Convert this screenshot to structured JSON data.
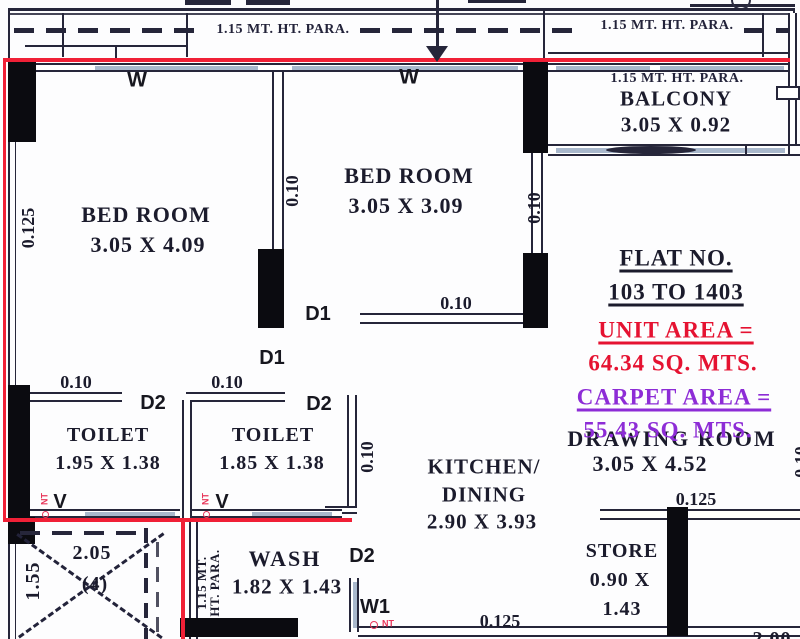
{
  "colors": {
    "ink": "#26263a",
    "wall_black": "#0b0b10",
    "window_blue": "#a9b8cc",
    "red_highlight_line": "#f02036",
    "flat_no_text": "#15151f",
    "unit_area_text": "#e51231",
    "carpet_area_text": "#8d2cd6",
    "vent_red_text": "#e8365a"
  },
  "top_band": {
    "parapet_left": "1.15 MT. HT. PARA.",
    "parapet_right": "1.15 MT. HT. PARA."
  },
  "balcony": {
    "parapet": "1.15 MT. HT. PARA.",
    "name": "BALCONY",
    "dims": "3.05 X 0.92"
  },
  "rooms": {
    "bedroom_left": {
      "name": "BED ROOM",
      "dims": "3.05 X 4.09"
    },
    "bedroom_mid": {
      "name": "BED ROOM",
      "dims": "3.05 X 3.09"
    },
    "toilet_left": {
      "name": "TOILET",
      "dims": "1.95 X 1.38"
    },
    "toilet_mid": {
      "name": "TOILET",
      "dims": "1.85 X 1.38"
    },
    "kitchen": {
      "name_line1": "KITCHEN/",
      "name_line2": "DINING",
      "dims": "2.90 X 3.93"
    },
    "drawing_room": {
      "name": "DRAWING ROOM",
      "dims": "3.05 X 4.52"
    },
    "wash": {
      "name": "WASH",
      "dims": "1.82 X 1.43"
    },
    "store": {
      "name": "STORE",
      "dims_line1": "0.90 X",
      "dims_line2": "1.43"
    }
  },
  "title_block": {
    "flat_no_label": "FLAT NO.",
    "flat_no_value": "103 TO 1403",
    "unit_area_label": "UNIT AREA =",
    "unit_area_value": "64.34 SQ. MTS.",
    "carpet_area_label": "CARPET AREA =",
    "carpet_area_value": "55.43 SQ. MTS."
  },
  "shaft": {
    "width": "2.05",
    "height": "1.55",
    "count": "(4)"
  },
  "wash_parapet": {
    "line1": "1.15 MT.",
    "line2": "HT. PARA."
  },
  "dims": {
    "wall_010": "0.10",
    "wall_0125": "0.125"
  },
  "openings": {
    "d1": "D1",
    "d2": "D2",
    "w": "W",
    "w1": "W1",
    "v": "V",
    "nt": "NT"
  },
  "partial": {
    "bottom_right_dim": "2.00"
  }
}
